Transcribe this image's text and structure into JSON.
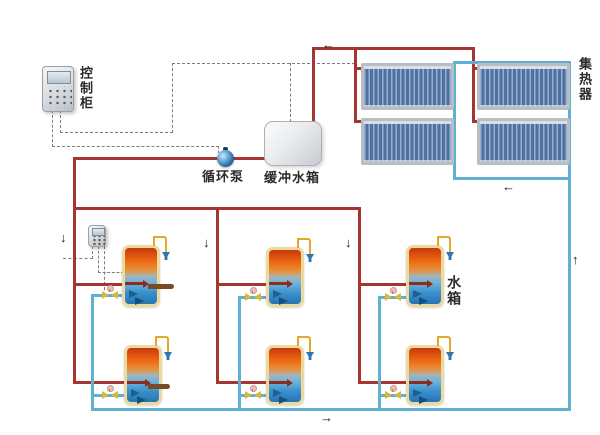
{
  "diagram": {
    "type": "solar-water-heating-system-schematic",
    "labels": {
      "control_cabinet": "控制柜",
      "circulation_pump": "循环泵",
      "buffer_tank": "缓冲水箱",
      "collector": "集热器",
      "water_tank": "水箱"
    },
    "arrows": {
      "down": "↓",
      "up": "↑",
      "left": "←",
      "right": "→"
    },
    "colors": {
      "hot_water_pipe": "#a63430",
      "cold_water_pipe": "#5fb0d2",
      "control_line": "#7d7d7d",
      "valve": "#d9b838",
      "drain_pipe": "#7a4a28",
      "tank_border": "#ecd9a0"
    },
    "counts": {
      "collector_panels": 4,
      "storage_tanks": 6,
      "valves": 6
    }
  }
}
